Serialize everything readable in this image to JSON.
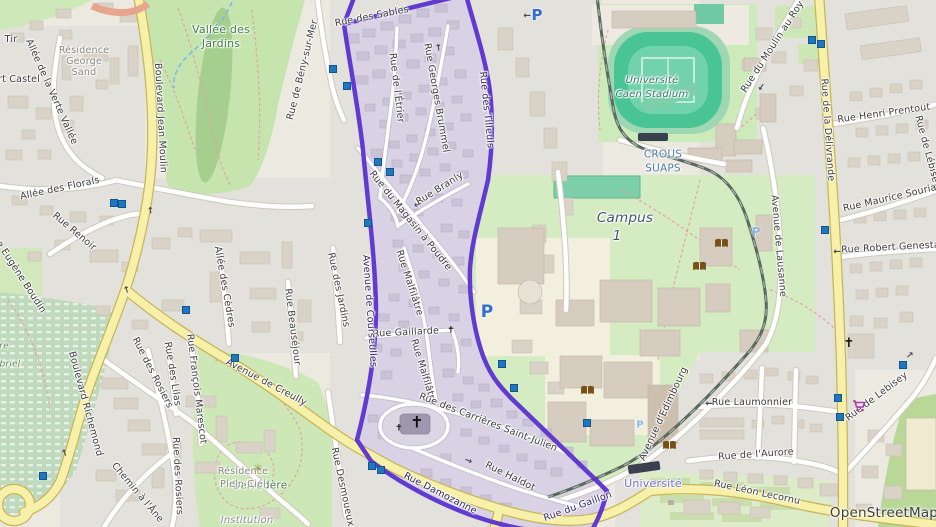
{
  "attribution": "OpenStreetMap",
  "boundary": {
    "color": "#5b32cf",
    "name": "Quartier Saint-Julien boundary"
  },
  "labels": [
    {
      "t": "Boulevard Jean Moulin",
      "x": 160,
      "y": 118,
      "r": 87,
      "cls": "street"
    },
    {
      "t": "Boulevard Richemond",
      "x": 85,
      "y": 404,
      "r": 75,
      "cls": "street"
    },
    {
      "t": "Avenue de Creully",
      "x": 266,
      "y": 383,
      "r": 28,
      "cls": "street"
    },
    {
      "t": "Rue Damozanne",
      "x": 440,
      "y": 494,
      "r": 27,
      "cls": "street onpurple"
    },
    {
      "t": "Rue du Gaillon",
      "x": 578,
      "y": 507,
      "r": -20,
      "cls": "street onpurple"
    },
    {
      "t": "Rue Léon Lecornu",
      "x": 757,
      "y": 493,
      "r": 12,
      "cls": "street"
    },
    {
      "t": "Rue de l'Aurore",
      "x": 756,
      "y": 455,
      "r": -4,
      "cls": "street"
    },
    {
      "t": "Rue Laumonnier",
      "x": 752,
      "y": 403,
      "r": 0,
      "cls": "street"
    },
    {
      "t": "Avenue d'Edimbourg",
      "x": 664,
      "y": 414,
      "r": -65,
      "cls": "street"
    },
    {
      "t": "Rue de Lebisey",
      "x": 877,
      "y": 397,
      "r": -37,
      "cls": "street"
    },
    {
      "t": "Rue de Lébisey",
      "x": 927,
      "y": 152,
      "r": 75,
      "cls": "street"
    },
    {
      "t": "Rue de la Délivrande",
      "x": 827,
      "y": 130,
      "r": 86,
      "cls": "street"
    },
    {
      "t": "Rue Henri Prentout",
      "x": 884,
      "y": 114,
      "r": -8,
      "cls": "street"
    },
    {
      "t": "Rue Maurice Souriau",
      "x": 893,
      "y": 198,
      "r": -13,
      "cls": "street"
    },
    {
      "t": "Rue Robert Genestal",
      "x": 892,
      "y": 248,
      "r": -3,
      "cls": "street"
    },
    {
      "t": "Rue du Moulin au Roy",
      "x": 773,
      "y": 47,
      "r": -57,
      "cls": "street"
    },
    {
      "t": "Avenue de Lausanne",
      "x": 778,
      "y": 246,
      "r": 85,
      "cls": "street"
    },
    {
      "t": "Rue de Bény-sur-Mer",
      "x": 303,
      "y": 70,
      "r": -76,
      "cls": "street"
    },
    {
      "t": "Rue des Sables",
      "x": 372,
      "y": 17,
      "r": -11,
      "cls": "street"
    },
    {
      "t": "Rue de l'Étrier",
      "x": 396,
      "y": 88,
      "r": 83,
      "cls": "street"
    },
    {
      "t": "Rue Georges Brummel",
      "x": 436,
      "y": 98,
      "r": 80,
      "cls": "street"
    },
    {
      "t": "Rue Branly",
      "x": 440,
      "y": 189,
      "r": -32,
      "cls": "street"
    },
    {
      "t": "Rue du Magasin à Poudre",
      "x": 410,
      "y": 221,
      "r": 51,
      "cls": "street"
    },
    {
      "t": "Rue Malfilâtre",
      "x": 409,
      "y": 283,
      "r": 72,
      "cls": "street"
    },
    {
      "t": "Rue Malfilâtre",
      "x": 423,
      "y": 372,
      "r": 73,
      "cls": "street"
    },
    {
      "t": "Rue Gaillarde",
      "x": 406,
      "y": 333,
      "r": -3,
      "cls": "street"
    },
    {
      "t": "Rue des Carrières Saint-Julien",
      "x": 488,
      "y": 423,
      "r": 21,
      "cls": "street"
    },
    {
      "t": "Rue Haldot",
      "x": 510,
      "y": 477,
      "r": 26,
      "cls": "street"
    },
    {
      "t": "Rue des Jardins",
      "x": 338,
      "y": 290,
      "r": 78,
      "cls": "street"
    },
    {
      "t": "Rue Desmoueux",
      "x": 342,
      "y": 487,
      "r": 78,
      "cls": "street"
    },
    {
      "t": "Rue des Rosiers",
      "x": 152,
      "y": 373,
      "r": 63,
      "cls": "street"
    },
    {
      "t": "Rue des Lilas",
      "x": 172,
      "y": 374,
      "r": 81,
      "cls": "street"
    },
    {
      "t": "Rue François Marescot",
      "x": 196,
      "y": 389,
      "r": 83,
      "cls": "street"
    },
    {
      "t": "Rue des Rosiers",
      "x": 177,
      "y": 476,
      "r": 87,
      "cls": "street"
    },
    {
      "t": "Chemin à l'Âne",
      "x": 137,
      "y": 493,
      "r": 50,
      "cls": "street"
    },
    {
      "t": "Allée de la Verte Vallée",
      "x": 51,
      "y": 92,
      "r": 66,
      "cls": "street"
    },
    {
      "t": "ert Castel",
      "x": 16,
      "y": 80,
      "r": 0,
      "cls": "street"
    },
    {
      "t": "Allée des Florals",
      "x": 60,
      "y": 189,
      "r": -12,
      "cls": "street"
    },
    {
      "t": "Rue Renoir",
      "x": 74,
      "y": 232,
      "r": 40,
      "cls": "street"
    },
    {
      "t": "Rue Eugène Boudin",
      "x": 17,
      "y": 272,
      "r": 57,
      "cls": "street"
    },
    {
      "t": "Allée des Cèdres",
      "x": 224,
      "y": 287,
      "r": 80,
      "cls": "street"
    },
    {
      "t": "Rue Beauséjour",
      "x": 292,
      "y": 327,
      "r": 83,
      "cls": "street"
    },
    {
      "t": "Avenue de Courseulles",
      "x": 369,
      "y": 311,
      "r": 86,
      "cls": "street onpurple"
    },
    {
      "t": "Rue des Tilleuls",
      "x": 486,
      "y": 110,
      "r": 84,
      "cls": "street onpurple"
    },
    {
      "t": "Tir",
      "x": 11,
      "y": 40,
      "r": 0,
      "cls": "street"
    },
    {
      "t": "Vallée des",
      "x": 221,
      "y": 30,
      "r": 0,
      "cls": "park"
    },
    {
      "t": "Jardins",
      "x": 221,
      "y": 44,
      "r": 0,
      "cls": "park"
    },
    {
      "t": "Résidence",
      "x": 84,
      "y": 51,
      "r": 0,
      "cls": "res"
    },
    {
      "t": "George",
      "x": 84,
      "y": 62,
      "r": 0,
      "cls": "res"
    },
    {
      "t": "Sand",
      "x": 84,
      "y": 73,
      "r": 0,
      "cls": "res"
    },
    {
      "t": "Université",
      "x": 652,
      "y": 81,
      "r": 0,
      "cls": "stadium"
    },
    {
      "t": "Caen Stadium",
      "x": 652,
      "y": 95,
      "r": 0,
      "cls": "stadium"
    },
    {
      "t": "CROUS",
      "x": 663,
      "y": 155,
      "r": 0,
      "cls": "crous"
    },
    {
      "t": "SUAPS",
      "x": 663,
      "y": 169,
      "r": 0,
      "cls": "crous"
    },
    {
      "t": "Campus",
      "x": 625,
      "y": 218,
      "r": 0,
      "cls": "campus"
    },
    {
      "t": "1",
      "x": 617,
      "y": 236,
      "r": 0,
      "cls": "campus"
    },
    {
      "t": "Belvédère",
      "x": 260,
      "y": 486,
      "r": 0,
      "cls": "park2"
    },
    {
      "t": "Résidence",
      "x": 243,
      "y": 472,
      "r": 0,
      "cls": "res"
    },
    {
      "t": "Plein Ciel",
      "x": 243,
      "y": 485,
      "r": 0,
      "cls": "res"
    },
    {
      "t": "Institution",
      "x": 247,
      "y": 521,
      "r": 0,
      "cls": "res-it"
    },
    {
      "t": "re",
      "x": 4,
      "y": 347,
      "r": 0,
      "cls": "cem"
    },
    {
      "t": "briel",
      "x": 10,
      "y": 365,
      "r": 0,
      "cls": "cem"
    },
    {
      "t": "Université",
      "x": 653,
      "y": 484,
      "r": 0,
      "cls": "tram"
    },
    {
      "t": "OpenStreetMap",
      "x": 884,
      "y": 513,
      "r": 0,
      "cls": "attr"
    }
  ],
  "arrows": [
    {
      "x": 527,
      "y": 14,
      "r": 180
    },
    {
      "x": 152,
      "y": 210,
      "r": -95
    },
    {
      "x": 128,
      "y": 289,
      "r": -105
    },
    {
      "x": 66,
      "y": 452,
      "r": -110
    },
    {
      "x": 417,
      "y": 203,
      "r": 160
    },
    {
      "x": 468,
      "y": 462,
      "r": 22
    },
    {
      "x": 709,
      "y": 402,
      "r": 180
    },
    {
      "x": 837,
      "y": 250,
      "r": 180
    },
    {
      "x": 760,
      "y": 86,
      "r": 125
    },
    {
      "x": 440,
      "y": 47,
      "r": -97
    },
    {
      "x": 911,
      "y": 356,
      "r": -42
    },
    {
      "x": 643,
      "y": 464,
      "r": 162
    }
  ],
  "icons": {
    "parking": [
      {
        "x": 537,
        "y": 15,
        "s": 15,
        "light": false
      },
      {
        "x": 487,
        "y": 312,
        "s": 17,
        "light": false
      },
      {
        "x": 756,
        "y": 232,
        "s": 12,
        "light": true
      },
      {
        "x": 640,
        "y": 425,
        "s": 10,
        "light": true
      }
    ],
    "bus_stops": [
      {
        "x": 333,
        "y": 69
      },
      {
        "x": 347,
        "y": 86
      },
      {
        "x": 378,
        "y": 162
      },
      {
        "x": 390,
        "y": 172
      },
      {
        "x": 368,
        "y": 223
      },
      {
        "x": 186,
        "y": 310
      },
      {
        "x": 114,
        "y": 203
      },
      {
        "x": 122,
        "y": 204
      },
      {
        "x": 43,
        "y": 476
      },
      {
        "x": 235,
        "y": 358
      },
      {
        "x": 372,
        "y": 466
      },
      {
        "x": 381,
        "y": 470
      },
      {
        "x": 502,
        "y": 364
      },
      {
        "x": 514,
        "y": 388
      },
      {
        "x": 812,
        "y": 40
      },
      {
        "x": 821,
        "y": 44
      },
      {
        "x": 825,
        "y": 230
      },
      {
        "x": 838,
        "y": 398
      },
      {
        "x": 840,
        "y": 417
      },
      {
        "x": 903,
        "y": 365
      },
      {
        "x": 587,
        "y": 423
      }
    ],
    "libraries": [
      {
        "x": 714,
        "y": 238
      },
      {
        "x": 692,
        "y": 261
      },
      {
        "x": 580,
        "y": 385
      },
      {
        "x": 662,
        "y": 440
      }
    ],
    "supermarkets": [
      {
        "x": 852,
        "y": 400
      }
    ],
    "churches": [
      {
        "x": 417,
        "y": 423,
        "s": 16
      },
      {
        "x": 399,
        "y": 429,
        "s": 9
      },
      {
        "x": 451,
        "y": 331,
        "s": 9
      },
      {
        "x": 849,
        "y": 344,
        "s": 13
      }
    ],
    "viewpoints": [
      {
        "x": 258,
        "y": 469
      }
    ]
  }
}
